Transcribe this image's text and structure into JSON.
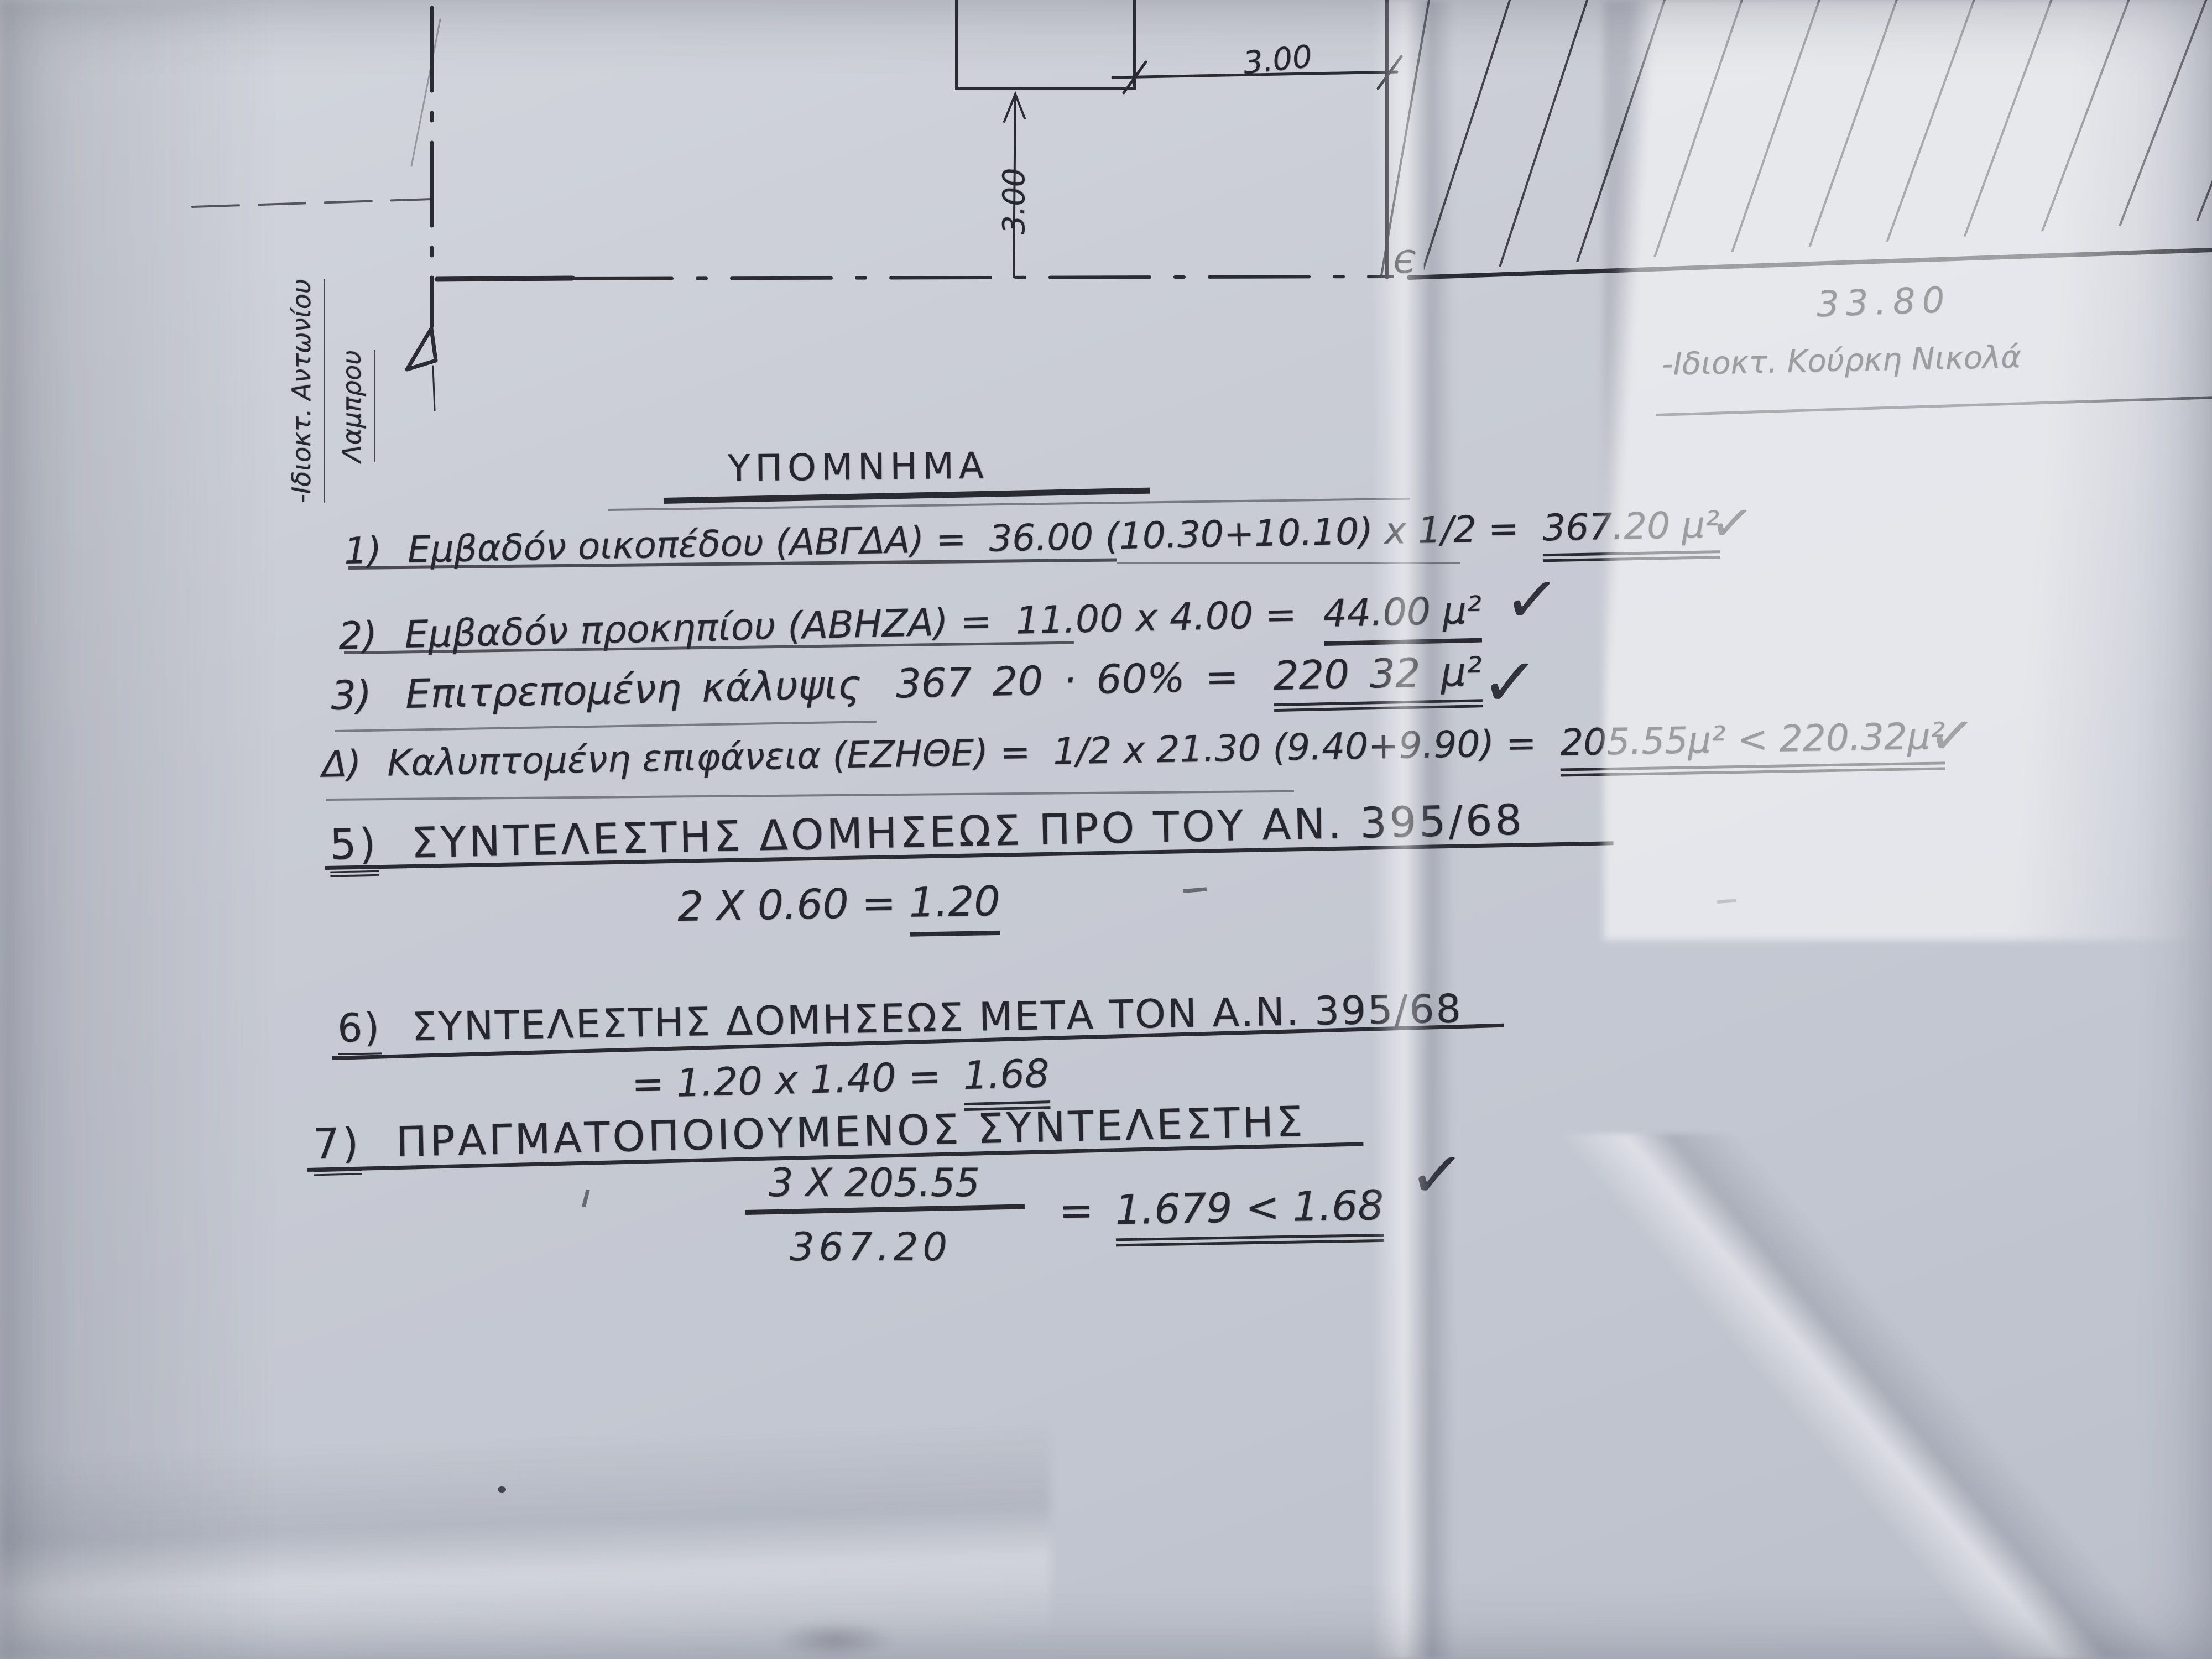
{
  "memo": {
    "title": "ΥΠΟΜΝΗΜΑ",
    "items": [
      {
        "num": "1)",
        "body": "Εμβαδόν οικοπέδου (ΑΒΓΔΑ) =",
        "calc": "36.00 (10.30+10.10) x 1/2 =",
        "result": "367.20 μ²",
        "check": "✓"
      },
      {
        "num": "2)",
        "body": "Εμβαδόν προκηπίου (ΑΒΗΖΑ) =",
        "calc": "11.00 x 4.00 =",
        "result": "44.00 μ²",
        "check": "✓"
      },
      {
        "num": "3)",
        "body": "Επιτρεπομένη κάλυψις",
        "calc": "367 20 · 60% =",
        "result": "220 32 μ²",
        "check": "✓"
      },
      {
        "num": "Δ)",
        "body": "Καλυπτομένη επιφάνεια (ΕΖΗΘΕ) =",
        "calc": "1/2 x 21.30 (9.40+9.90) =",
        "result": "205.55μ² < 220.32μ²",
        "check": "✓"
      },
      {
        "num": "5)",
        "body": "ΣΥΝΤΕΛΕΣΤΗΣ ΔΟΜΗΣΕΩΣ ΠΡΟ ΤΟΥ ΑΝ. 395/68",
        "calc": "2 X 0.60 =",
        "result": "1.20"
      },
      {
        "num": "6)",
        "body": "ΣΥΝΤΕΛΕΣΤΗΣ ΔΟΜΗΣΕΩΣ ΜΕΤΑ ΤΟΝ Α.Ν. 395/68",
        "calc": "= 1.20 x 1.40 =",
        "result": "1.68"
      },
      {
        "num": "7)",
        "body": "ΠΡΑΓΜΑΤΟΠΟΙΟΥΜΕΝΟΣ ΣΥΝΤΕΛΕΣΤΗΣ",
        "fraction_numerator": "3 X 205.55",
        "fraction_denominator": "367.20",
        "result_prefix": "=",
        "result": "1.679 < 1.68",
        "check": "✓"
      }
    ]
  },
  "drawing": {
    "dim_top": "3.00",
    "dim_side": "3.00",
    "dim_frontage": "33.80",
    "point_label": "Є",
    "owner_left_line1": "-Ιδιοκτ. Αντωνίου",
    "owner_left_line2": "Λαμπρου",
    "owner_right": "-Ιδιοκτ. Κούρκη Νικολά",
    "ink_color": "#2a2a32"
  }
}
